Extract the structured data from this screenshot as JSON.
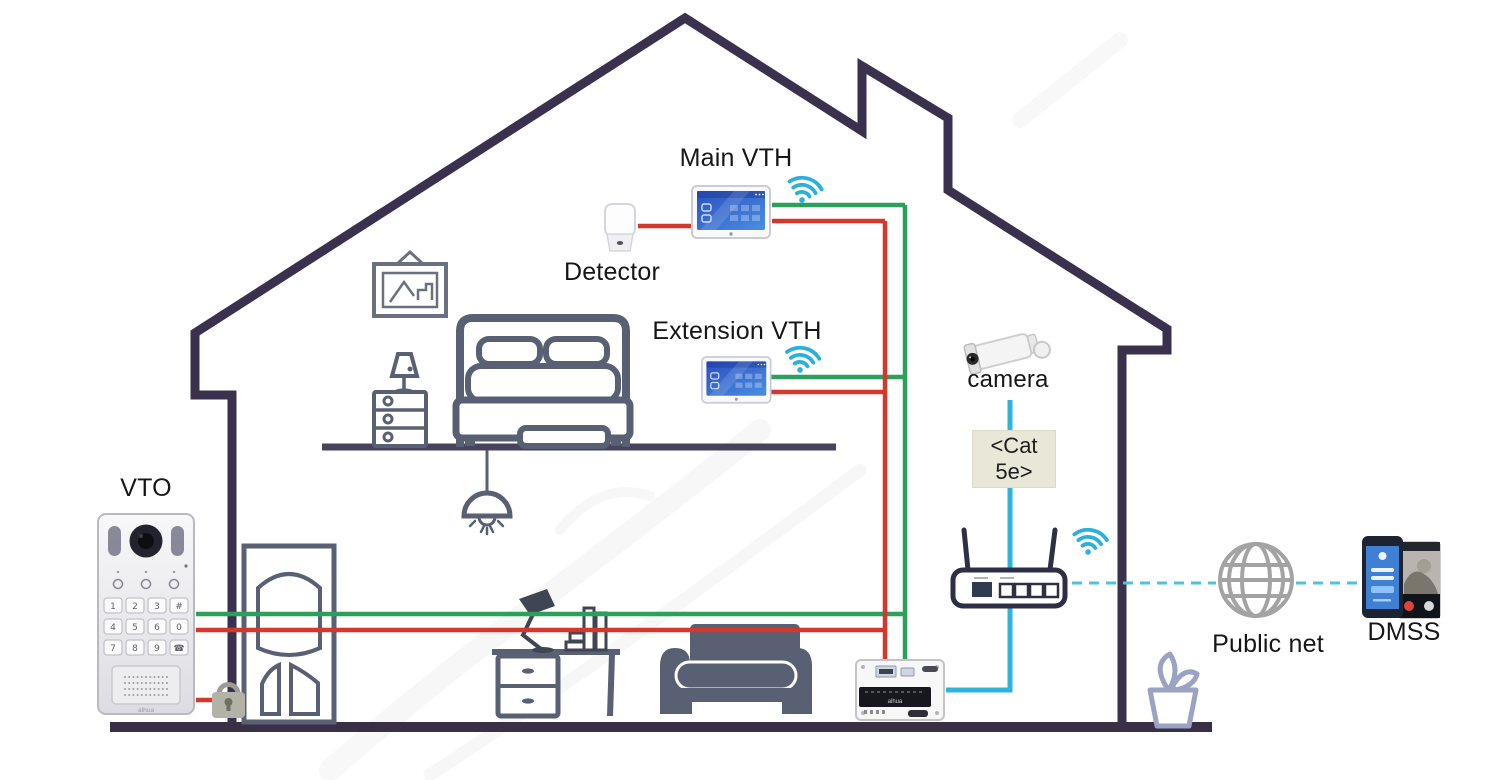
{
  "labels": {
    "vto": "VTO",
    "detector": "Detector",
    "main_vth": "Main VTH",
    "extension_vth": "Extension VTH",
    "camera": "camera",
    "cat5e_line1": "<Cat",
    "cat5e_line2": "5e>",
    "public_net": "Public net",
    "dmss": "DMSS"
  },
  "vto": {
    "logo": "alhua",
    "keypad": [
      "1",
      "2",
      "3",
      "#",
      "4",
      "5",
      "6",
      "0",
      "7",
      "8",
      "9",
      "☎"
    ]
  },
  "switch_logo": "alhua",
  "colors": {
    "house_outline": "#3a314e",
    "floor": "#3a3046",
    "furniture": "#596073",
    "wire_red": "#d4372c",
    "wire_green": "#2aa05a",
    "wire_blue": "#2fb3dd",
    "dashed_link": "#4fc4d9",
    "wifi": "#29b0dd",
    "screen_blue": "#3a63cf",
    "cat5e_bg": "#e9e7d8",
    "plant": "#9aa3c2",
    "globe": "#a3a3a3"
  },
  "connections": [
    {
      "from": "detector",
      "to": "main-vth",
      "color": "red"
    },
    {
      "from": "main-vth",
      "to": "switch",
      "color": "green"
    },
    {
      "from": "main-vth",
      "to": "switch",
      "color": "red"
    },
    {
      "from": "extension-vth",
      "to": "switch",
      "color": "green"
    },
    {
      "from": "extension-vth",
      "to": "switch",
      "color": "red"
    },
    {
      "from": "vto",
      "to": "switch",
      "color": "green"
    },
    {
      "from": "vto",
      "to": "switch",
      "color": "red"
    },
    {
      "from": "vto",
      "to": "door-lock",
      "color": "red"
    },
    {
      "from": "camera",
      "to": "router",
      "via": "Cat 5e",
      "color": "blue"
    },
    {
      "from": "router",
      "to": "switch",
      "color": "blue"
    },
    {
      "from": "router",
      "to": "public-net",
      "style": "dashed"
    },
    {
      "from": "public-net",
      "to": "dmss",
      "style": "dashed"
    }
  ]
}
